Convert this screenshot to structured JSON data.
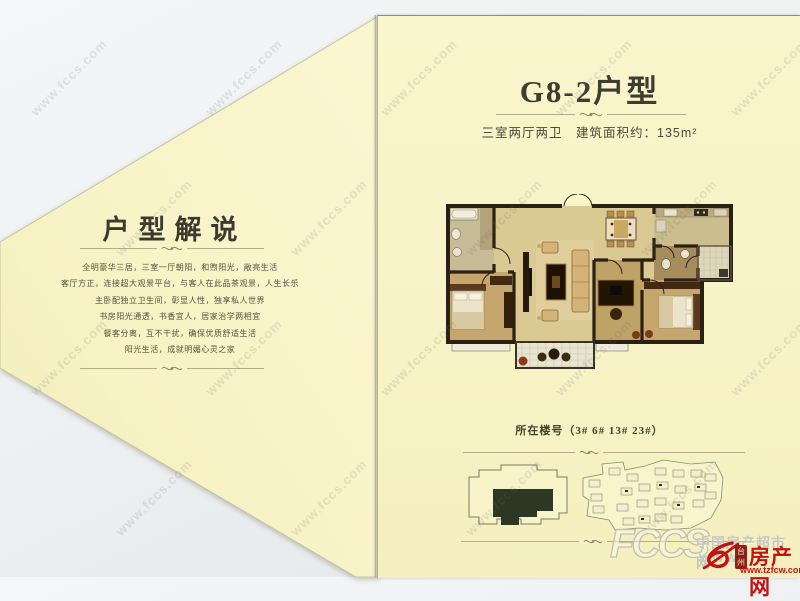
{
  "brochure": {
    "left_panel": {
      "title": "户型解说",
      "lines": [
        "全明豪华三居，三室一厅朝阳，和煦阳光，敞亮生活",
        "客厅方正，连接超大观景平台，与客人在此品茶观景，人生长乐",
        "主卧配独立卫生间，彰显人性，独享私人世界",
        "书房阳光通透，书香宜人，居家治学两相宜",
        "餐客分离，互不干扰，确保优质舒适生活",
        "阳光生活，成就明媚心灵之家"
      ]
    },
    "right_panel": {
      "title": "G8-2户型",
      "subtitle": "三室两厅两卫　建筑面积约：135m²",
      "location_label": "所在楼号（3#  6#  13#  23#）"
    }
  },
  "watermark": {
    "text": "www.fccs.com"
  },
  "footer": {
    "fccs_letters": "FCCS",
    "fccs_site_name": "中国房产超市网",
    "fccs_www": "WWW",
    "portal_name": "房产网",
    "portal_badge": "台州",
    "portal_url": "www.tzfcw.com.cn"
  },
  "colors": {
    "paper": "#f8f3c6",
    "background": "#edeff1",
    "wall": "#2a2014",
    "highlight_green": "#2d3824",
    "accent_red": "#c31212"
  }
}
